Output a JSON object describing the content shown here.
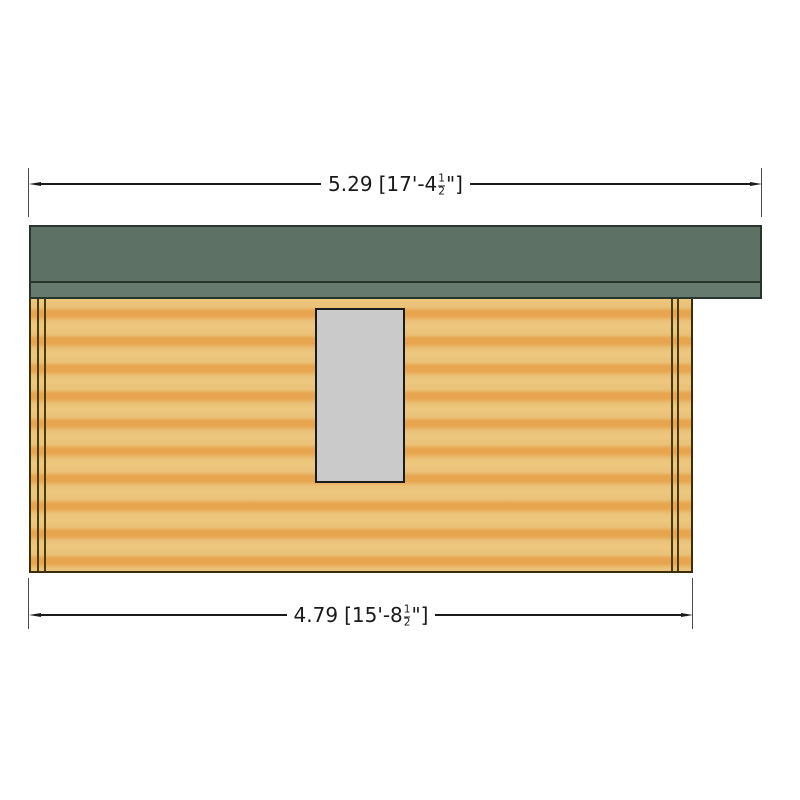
{
  "drawing": {
    "view": "side-elevation-of-log-cabin",
    "dimensions": {
      "roof_width": {
        "metric": "5.29",
        "imperial_prefix": "[17'-4",
        "fraction_numerator": "1",
        "fraction_denominator": "2",
        "imperial_suffix": "\"]"
      },
      "wall_width": {
        "metric": "4.79",
        "imperial_prefix": "[15'-8",
        "fraction_numerator": "1",
        "fraction_denominator": "2",
        "imperial_suffix": "\"]"
      }
    }
  },
  "colors": {
    "background": "#ffffff",
    "roof_main": "#5d7265",
    "roof_fascia": "#667b6d",
    "roof_outline": "#27352a",
    "wall_light": "#ecc87e",
    "wall_dark": "#e8a54f",
    "wall_outline": "#3c2d0d",
    "window_fill": "#cacaca",
    "window_outline": "#1b1b1b",
    "dimension_line": "#1a1a1a"
  }
}
